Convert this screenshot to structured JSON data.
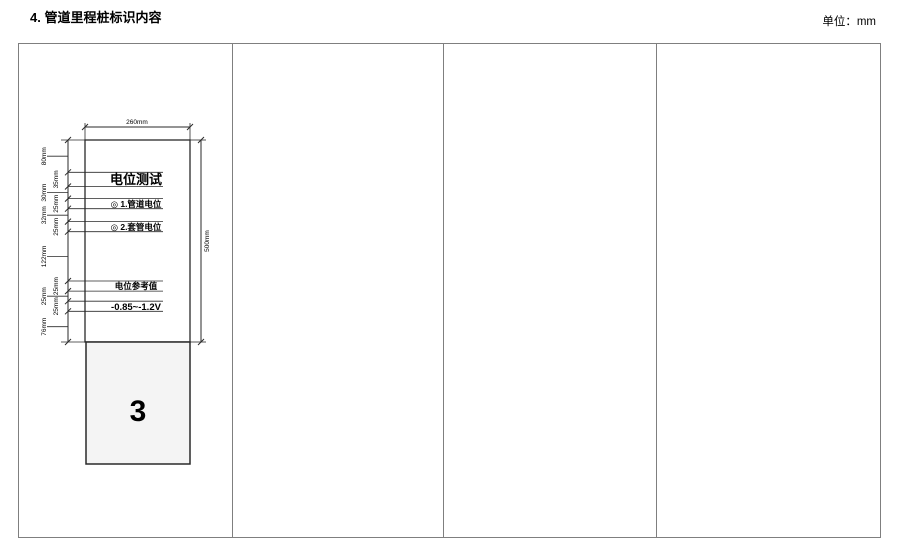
{
  "header": {
    "title": "4. 管道里程桩标识内容",
    "unit": "单位：mm"
  },
  "diagram": {
    "sign": {
      "title": "电位测试",
      "item1": "◎ 1.管道电位",
      "item2": "◎ 2.套管电位",
      "ref_label": "电位参考值",
      "ref_value": "-0.85~-1.2V",
      "base_number": "3"
    },
    "dims": {
      "width": "260mm",
      "height": "500mm",
      "segments": [
        "80mm",
        "35mm",
        "30mm",
        "25mm",
        "32mm",
        "25mm",
        "122mm",
        "25mm",
        "25mm",
        "25mm",
        "76mm"
      ]
    }
  },
  "colors": {
    "line": "#2a2a2a",
    "table_border": "#7f7f7f",
    "base_fill": "#f4f4f4",
    "sign_fill": "#ffffff"
  }
}
